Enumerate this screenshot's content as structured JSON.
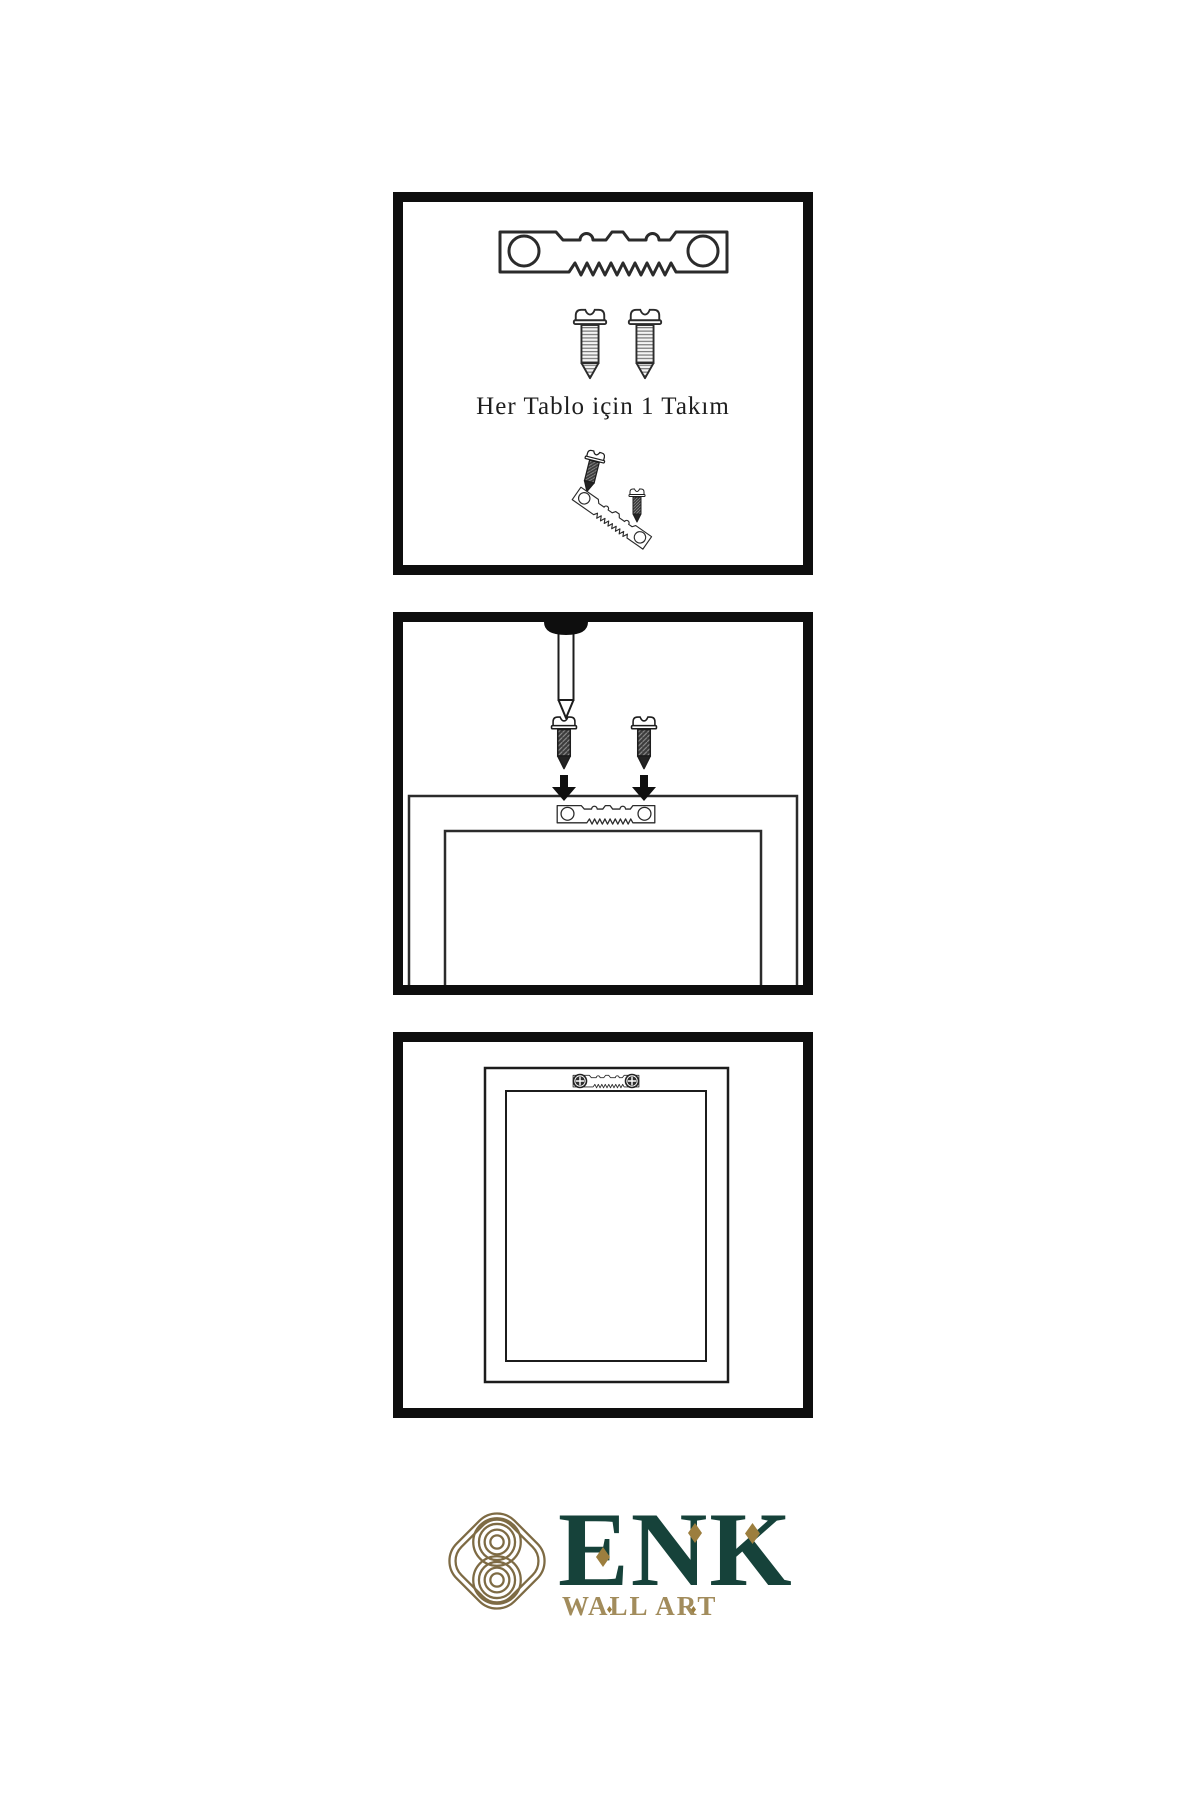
{
  "canvas": {
    "width": 1200,
    "height": 1800,
    "background": "#ffffff"
  },
  "colors": {
    "ink": "#1f1f1f",
    "panel_border": "#0e0e0e",
    "screw_dark_fill": "#3c3c3c",
    "logo_green": "#16423a",
    "logo_gold": "#9c7e3e",
    "logo_tan": "#a28c5c",
    "emblem_gold": "#7e6b44"
  },
  "panel_kit": {
    "caption": "Her Tablo için 1 Takım",
    "icons": [
      "sawtooth-hanger-icon",
      "screw-icon",
      "screw-icon",
      "dark-screw-tilted-icon",
      "dark-screw-icon",
      "sawtooth-hanger-tilted-icon"
    ]
  },
  "panel_install": {
    "icons": [
      "nail-icon",
      "dark-screw-icon",
      "dark-screw-icon",
      "arrow-down-icon",
      "arrow-down-icon",
      "sawtooth-hanger-icon",
      "frame-back"
    ]
  },
  "panel_hang": {
    "icons": [
      "picture-frame",
      "sawtooth-hanger-icon",
      "phillips-screw-icon",
      "phillips-screw-icon"
    ]
  },
  "logo": {
    "brand": "ENK",
    "tagline": "WALL ART",
    "emblem": "knot-emblem-icon"
  }
}
